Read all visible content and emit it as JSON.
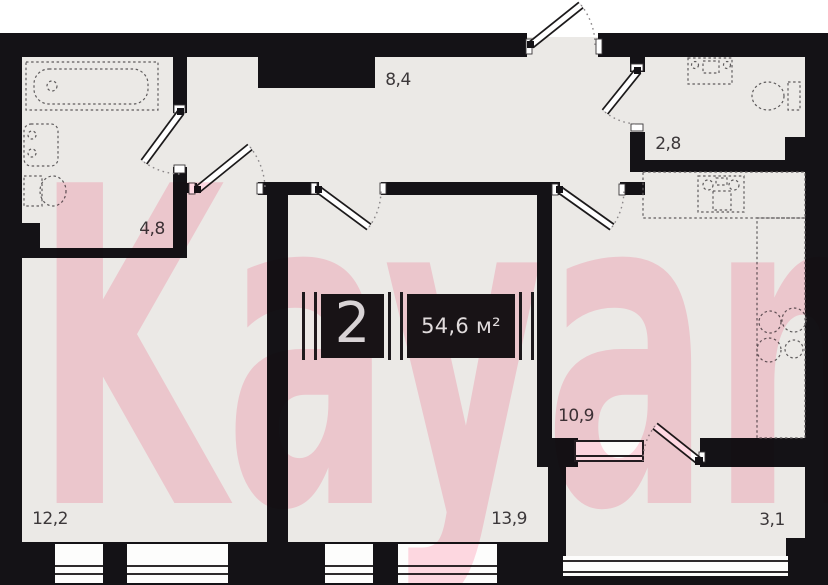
{
  "plan": {
    "title": "2-room apartment floor plan",
    "badge": {
      "room_count": "2",
      "area": "54,6 м²"
    },
    "watermark": {
      "text": "Kayan"
    },
    "rooms": [
      {
        "name": "hallway",
        "area": "8,4"
      },
      {
        "name": "wc",
        "area": "2,8"
      },
      {
        "name": "bathroom",
        "area": "4,8"
      },
      {
        "name": "kitchen",
        "area": "10,9"
      },
      {
        "name": "bedroom",
        "area": "12,2"
      },
      {
        "name": "living-room",
        "area": "13,9"
      },
      {
        "name": "balcony",
        "area": "3,1"
      }
    ],
    "colors": {
      "wall": "#141216",
      "floor": "#ebe9e6",
      "watermark_pink": "#ffd9e3",
      "badge_bg": "#181316",
      "badge_text": "#d8d3d5",
      "label_text": "#3c383a"
    }
  }
}
